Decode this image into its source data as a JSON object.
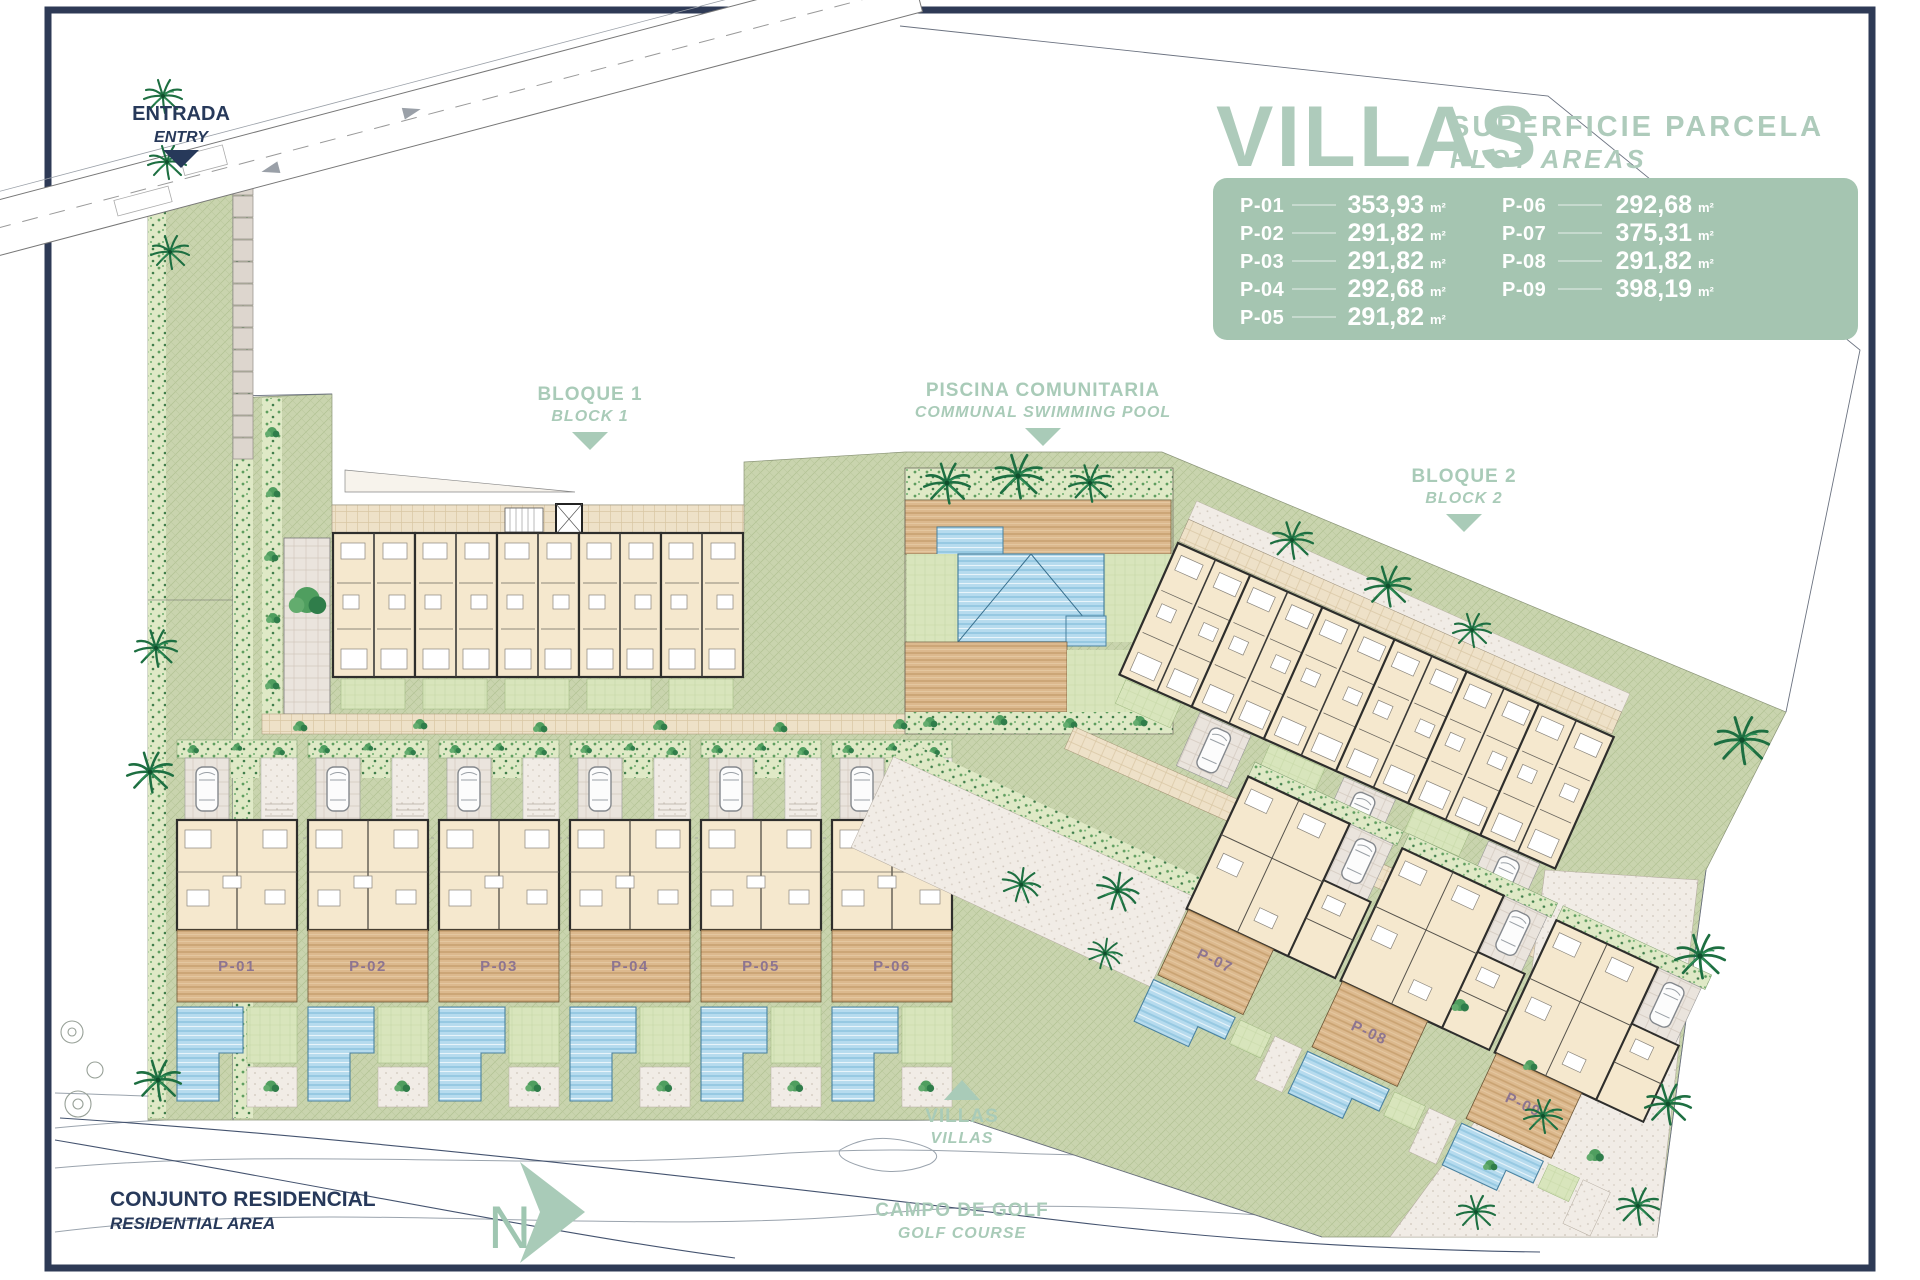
{
  "page": {
    "background": "#ffffff",
    "frame_color": "#2e3a56"
  },
  "legend": {
    "title": "VILLAS",
    "subtitle": "SUPERFICIE PARCELA",
    "subtitle_en": "PLOT AREAS",
    "unit": "m²",
    "panel_color": "#a5c5b1",
    "title_color": "#aecbbb",
    "plots": [
      {
        "id": "P-01",
        "area": "353,93"
      },
      {
        "id": "P-02",
        "area": "291,82"
      },
      {
        "id": "P-03",
        "area": "291,82"
      },
      {
        "id": "P-04",
        "area": "292,68"
      },
      {
        "id": "P-05",
        "area": "291,82"
      },
      {
        "id": "P-06",
        "area": "292,68"
      },
      {
        "id": "P-07",
        "area": "375,31"
      },
      {
        "id": "P-08",
        "area": "291,82"
      },
      {
        "id": "P-09",
        "area": "398,19"
      }
    ]
  },
  "annotations": {
    "entrance": {
      "label": "ENTRADA",
      "label_en": "ENTRY"
    },
    "block1": {
      "label": "BLOQUE 1",
      "label_en": "BLOCK 1"
    },
    "pool": {
      "label": "PISCINA COMUNITARIA",
      "label_en": "COMMUNAL SWIMMING POOL"
    },
    "block2": {
      "label": "BLOQUE 2",
      "label_en": "BLOCK 2"
    },
    "villas": {
      "label": "VILLAS",
      "label_en": "VILLAS"
    },
    "residential": {
      "label": "CONJUNTO RESIDENCIAL",
      "label_en": "RESIDENTIAL AREA"
    },
    "golf": {
      "label": "CAMPO DE GOLF",
      "label_en": "GOLF COURSE"
    },
    "north": {
      "label": "N"
    }
  },
  "colors": {
    "navy": "#27395a",
    "sage": "#a9cbb8",
    "green_area": "#c9d4ae",
    "pool_water": "#b6dbee",
    "deck_wood": "#dcb98e",
    "building": "#f5e8ce",
    "plot_label": "#8d7591"
  }
}
